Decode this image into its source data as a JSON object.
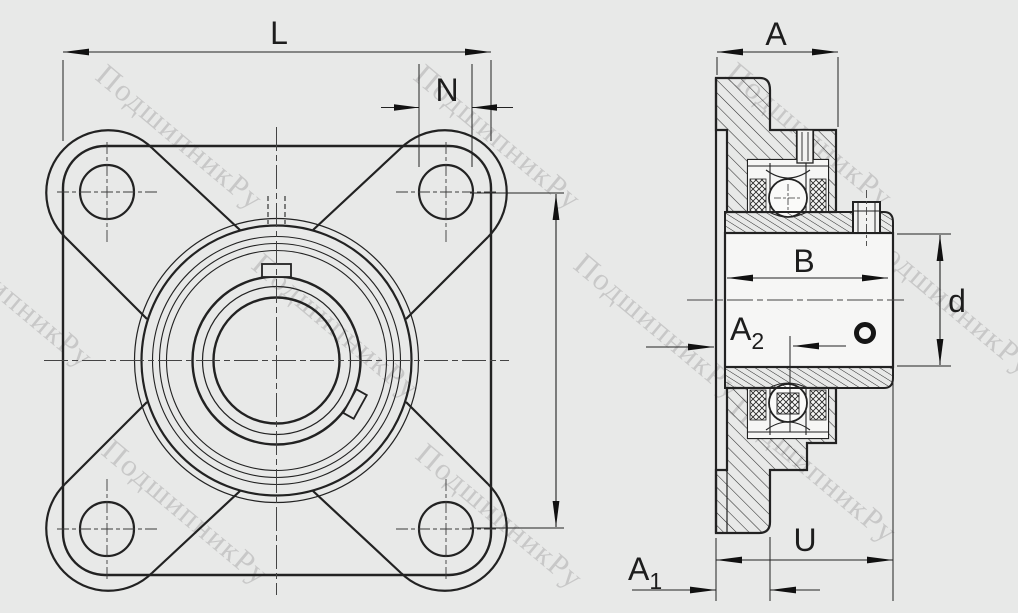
{
  "watermark": {
    "text": "ПодшипникРу",
    "color": "#c3c3c3"
  },
  "dimensions": {
    "front": {
      "overall_width": "L",
      "bolt_hole_diameter": "N"
    },
    "side": {
      "flange_depth": "A",
      "inner_ring_width": "B",
      "bore_diameter": "d",
      "total_width": "U",
      "protrusion": {
        "base": "A",
        "sub": "1"
      },
      "center_offset": {
        "base": "A",
        "sub": "2"
      }
    }
  },
  "colors": {
    "background": "#e8e9e8",
    "line": "#222222",
    "watermark": "#c3c3c3"
  }
}
